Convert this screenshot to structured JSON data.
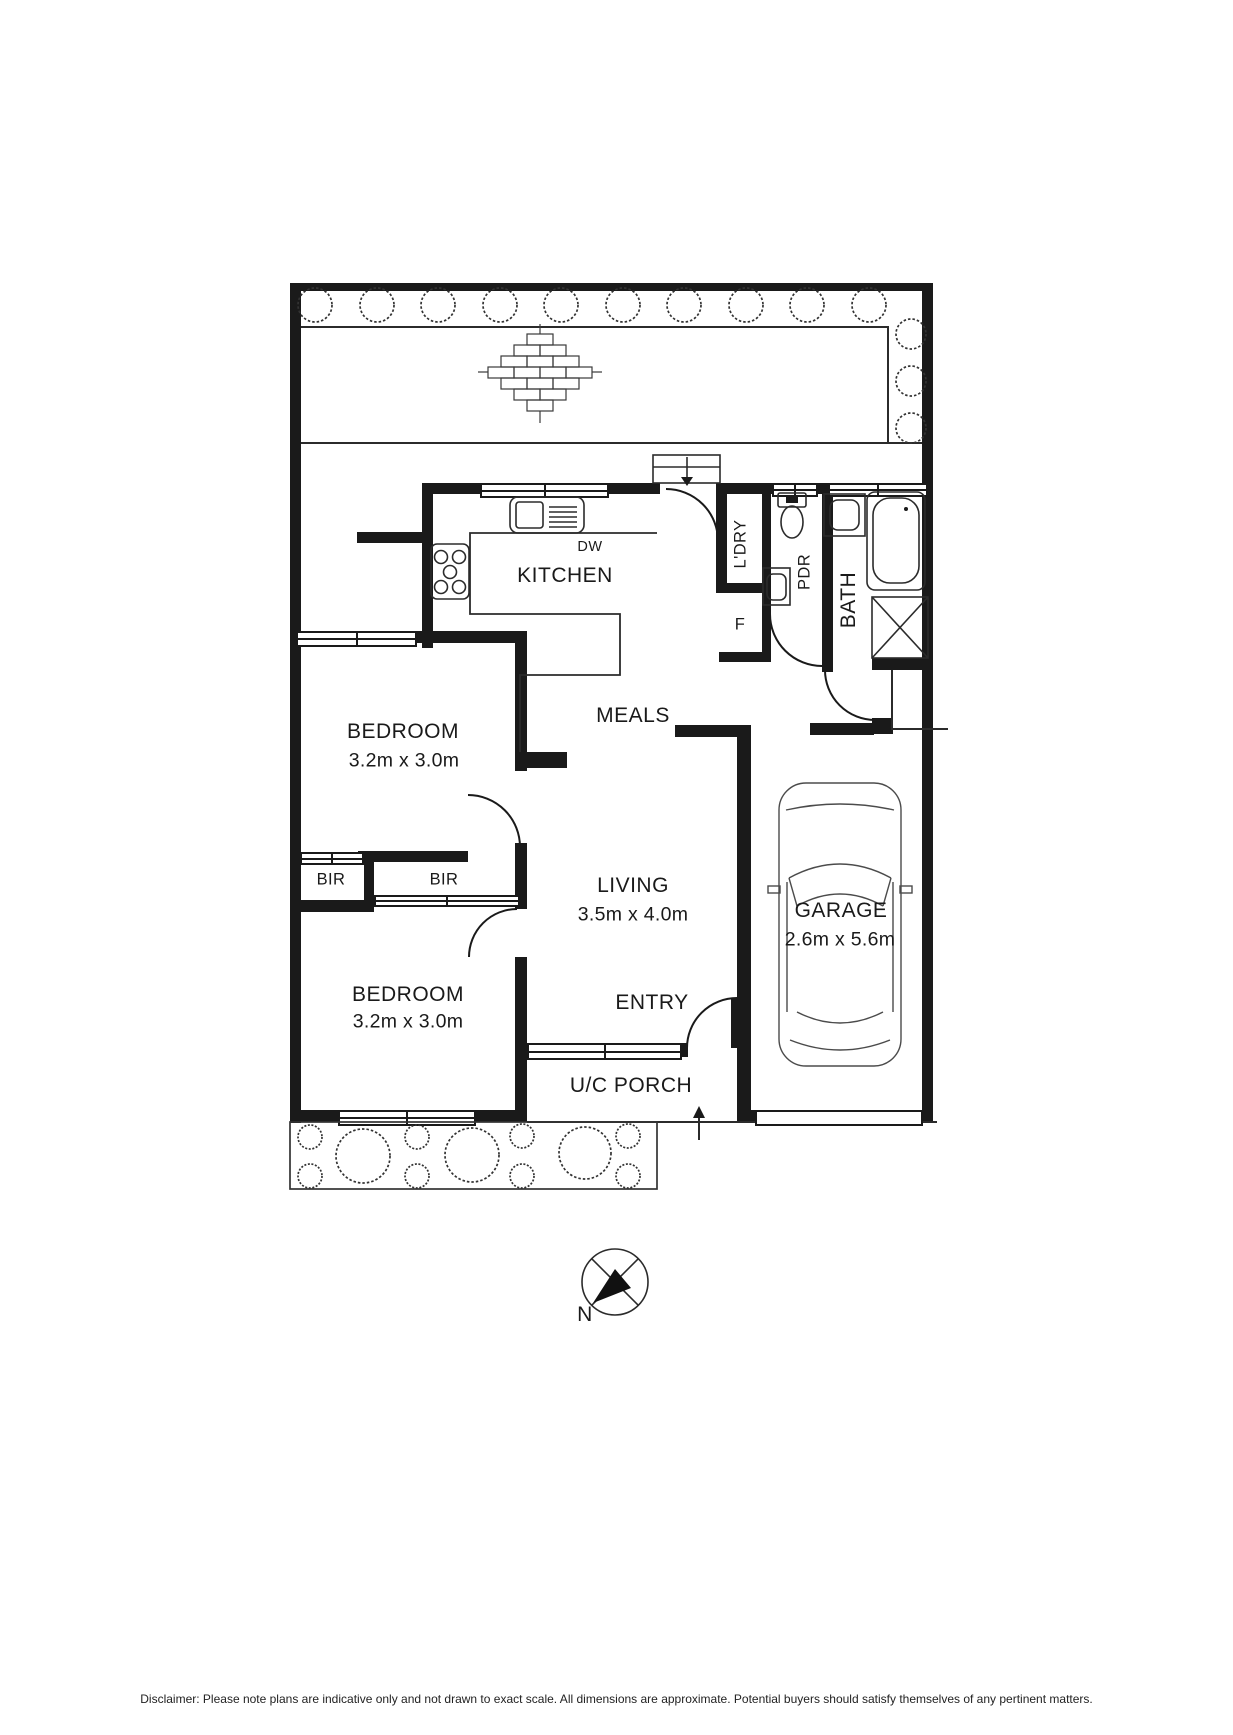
{
  "colors": {
    "line": "#1a1a1a",
    "background": "#ffffff"
  },
  "rooms": {
    "kitchen": {
      "label": "KITCHEN"
    },
    "meals": {
      "label": "MEALS"
    },
    "living": {
      "label": "LIVING",
      "dims": "3.5m x 4.0m"
    },
    "bedroom1": {
      "label": "BEDROOM",
      "dims": "3.2m x 3.0m"
    },
    "bedroom2": {
      "label": "BEDROOM",
      "dims": "3.2m x 3.0m"
    },
    "garage": {
      "label": "GARAGE",
      "dims": "2.6m x 5.6m"
    },
    "entry": {
      "label": "ENTRY"
    },
    "porch": {
      "label": "U/C PORCH"
    },
    "bath": {
      "label": "BATH"
    },
    "powder": {
      "label": "PDR"
    },
    "laundry": {
      "label": "L'DRY"
    },
    "bir_left": {
      "label": "BIR"
    },
    "bir_right": {
      "label": "BIR"
    }
  },
  "fixtures": {
    "dishwasher": "DW",
    "fridge": "F"
  },
  "compass": {
    "north": "N"
  },
  "disclaimer": {
    "text": "Disclaimer: Please note plans are indicative only and not drawn to exact scale. All dimensions are approximate. Potential buyers should satisfy themselves of any pertinent matters."
  }
}
